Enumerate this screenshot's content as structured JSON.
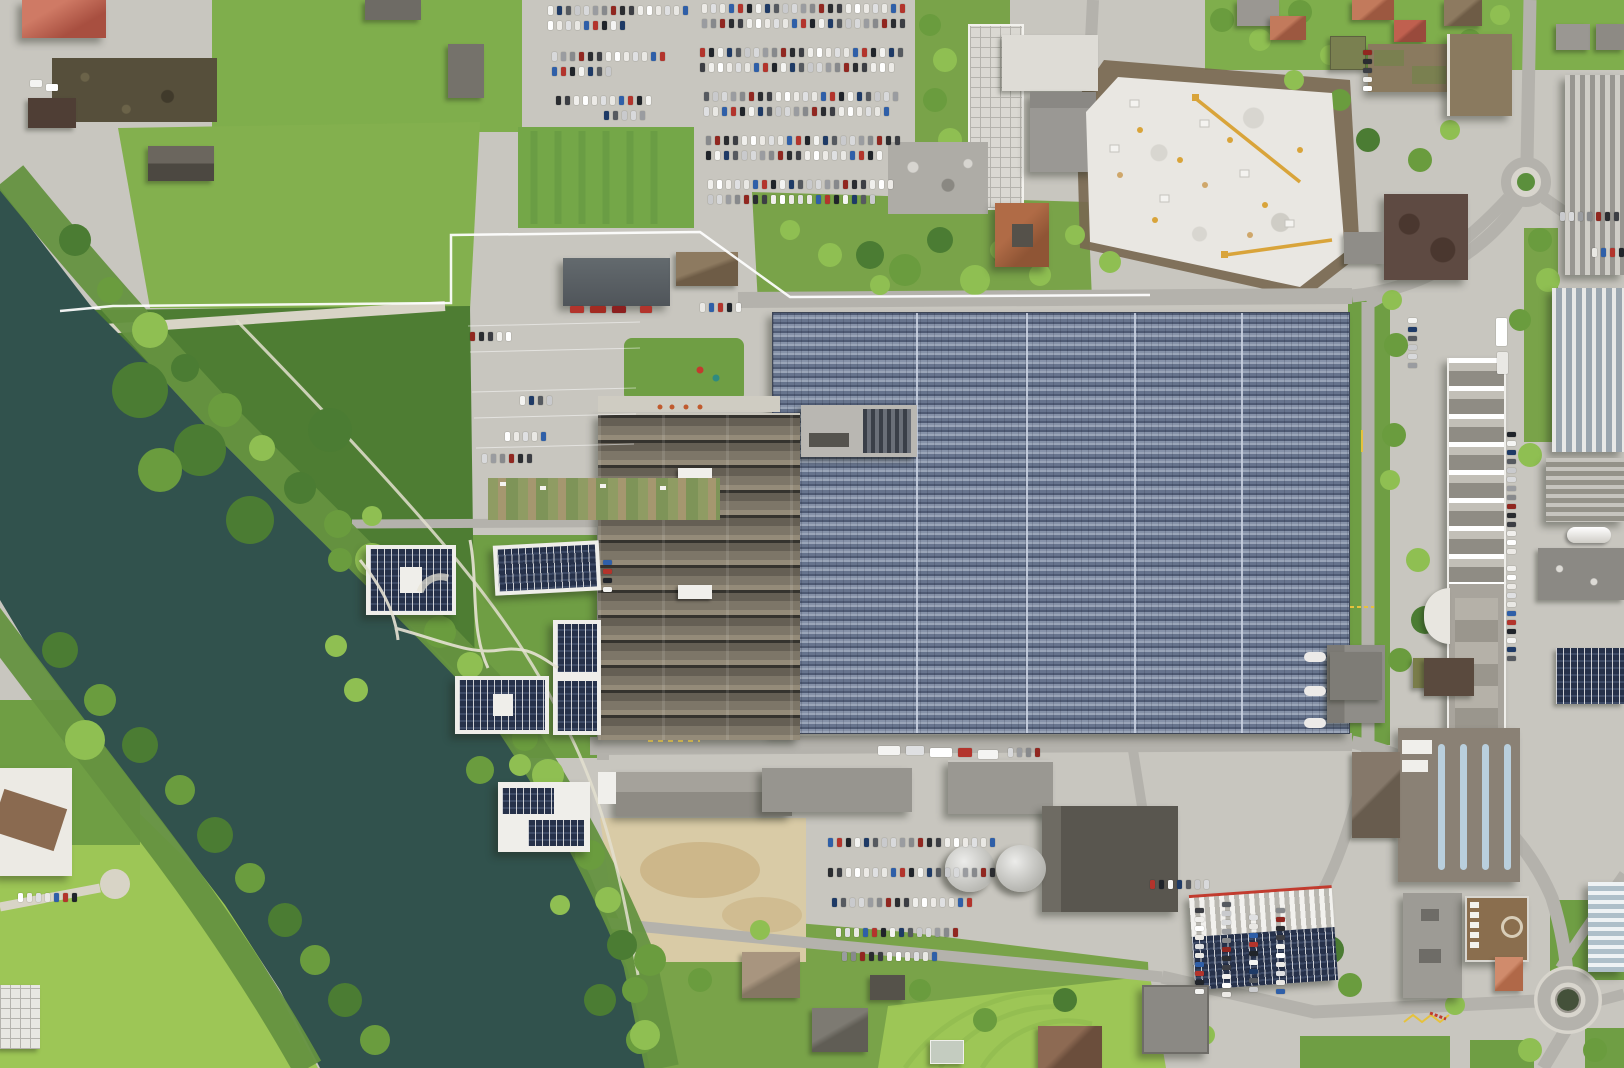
{
  "meta": {
    "title": "Aerial orthophoto — riverside industrial campus",
    "description": "Top-down aerial photograph of an industrial campus beside a dark green river: a large factory hall covered in blue solar panels, a sawtooth-roof factory, white apartment blocks with rooftop PV, crowded parking lots, a white construction site with yellow cranes, tree-lined river banks, green fields and two road roundabouts."
  },
  "scene": {
    "river_count": 1,
    "roundabouts": 2,
    "construction_cranes": 2,
    "solar_roof_buildings": 7,
    "water_tanks": 2
  },
  "colors": {
    "pavement": "#c8c6bf",
    "pavement_light": "#d8d5cd",
    "asphalt": "#b4b2ac",
    "gravel": "#d8d4c6",
    "water": "#31524d",
    "field": "#7fae4c",
    "field2": "#83b04e",
    "field_bright": "#9dc656",
    "lawn": "#6f9e44",
    "scrub": "#79a349",
    "bank_green": "#659240",
    "forest": "#4e7d33",
    "grass_square": "#74a748",
    "sand": "#d9cba6",
    "sand_dark": "#c9b283",
    "excavation": "#786750",
    "construction": "#e9e7e2",
    "crane_yellow": "#d9a43a",
    "concrete": "#b9b7b2",
    "gray_roof": "#96948e",
    "gray_roof_dark": "#59564f",
    "dark_roof": "#4f3e35",
    "brown_roof": "#7b5c49",
    "red_roof": "#b85b4a",
    "tile_roof": "#b36a50",
    "orange_roof": "#c77d5f",
    "boundary_white": "#ffffff",
    "mark_yellow": "#e6c23c",
    "mark_red": "#c23b2e",
    "tank_light": "#dcdcd8"
  },
  "parking": {
    "palette": [
      "#f4f4f2",
      "#dfe0e2",
      "#2a2c30",
      "#c9cacd",
      "#b3342c",
      "#ffffff",
      "#87898c",
      "#1e3a66",
      "#e9e8e4",
      "#3c3e44",
      "#d8d9db",
      "#20242a",
      "#eceae6",
      "#912720",
      "#565a60",
      "#2f5fa8",
      "#f0efec",
      "#9a9ca0"
    ],
    "rows": [
      {
        "x": 548,
        "y": 6,
        "count": 16
      },
      {
        "x": 548,
        "y": 21,
        "count": 9
      },
      {
        "x": 552,
        "y": 52,
        "count": 13
      },
      {
        "x": 552,
        "y": 67,
        "count": 7
      },
      {
        "x": 556,
        "y": 96,
        "count": 11
      },
      {
        "x": 604,
        "y": 111,
        "count": 5
      },
      {
        "x": 702,
        "y": 4,
        "count": 23
      },
      {
        "x": 702,
        "y": 19,
        "count": 23
      },
      {
        "x": 700,
        "y": 48,
        "count": 23
      },
      {
        "x": 700,
        "y": 63,
        "count": 22
      },
      {
        "x": 704,
        "y": 92,
        "count": 22
      },
      {
        "x": 704,
        "y": 107,
        "count": 21
      },
      {
        "x": 706,
        "y": 136,
        "count": 22
      },
      {
        "x": 706,
        "y": 151,
        "count": 20
      },
      {
        "x": 708,
        "y": 180,
        "count": 21
      },
      {
        "x": 708,
        "y": 195,
        "count": 19
      },
      {
        "x": 700,
        "y": 303,
        "count": 5
      },
      {
        "x": 470,
        "y": 332,
        "count": 5
      },
      {
        "x": 520,
        "y": 396,
        "count": 4
      },
      {
        "x": 505,
        "y": 432,
        "count": 5
      },
      {
        "x": 482,
        "y": 454,
        "count": 6
      },
      {
        "x": 828,
        "y": 838,
        "count": 19
      },
      {
        "x": 828,
        "y": 868,
        "count": 19
      },
      {
        "x": 832,
        "y": 898,
        "count": 16
      },
      {
        "x": 836,
        "y": 928,
        "count": 14
      },
      {
        "x": 842,
        "y": 952,
        "count": 11
      },
      {
        "x": 1150,
        "y": 880,
        "count": 7
      },
      {
        "x": 1195,
        "y": 908,
        "count": 10,
        "dir": "h"
      },
      {
        "x": 1222,
        "y": 902,
        "count": 11,
        "dir": "h"
      },
      {
        "x": 1249,
        "y": 915,
        "count": 9,
        "dir": "h"
      },
      {
        "x": 1276,
        "y": 908,
        "count": 10,
        "dir": "h"
      },
      {
        "x": 1507,
        "y": 432,
        "count": 14,
        "dir": "h"
      },
      {
        "x": 1507,
        "y": 566,
        "count": 11,
        "dir": "h"
      },
      {
        "x": 1560,
        "y": 212,
        "count": 7
      },
      {
        "x": 1592,
        "y": 248,
        "count": 4
      },
      {
        "x": 1363,
        "y": 50,
        "count": 5,
        "dir": "h"
      },
      {
        "x": 1408,
        "y": 318,
        "count": 6,
        "dir": "h"
      },
      {
        "x": 18,
        "y": 893,
        "count": 7
      },
      {
        "x": 1008,
        "y": 748,
        "count": 4
      },
      {
        "x": 603,
        "y": 560,
        "count": 4,
        "dir": "h"
      }
    ]
  }
}
